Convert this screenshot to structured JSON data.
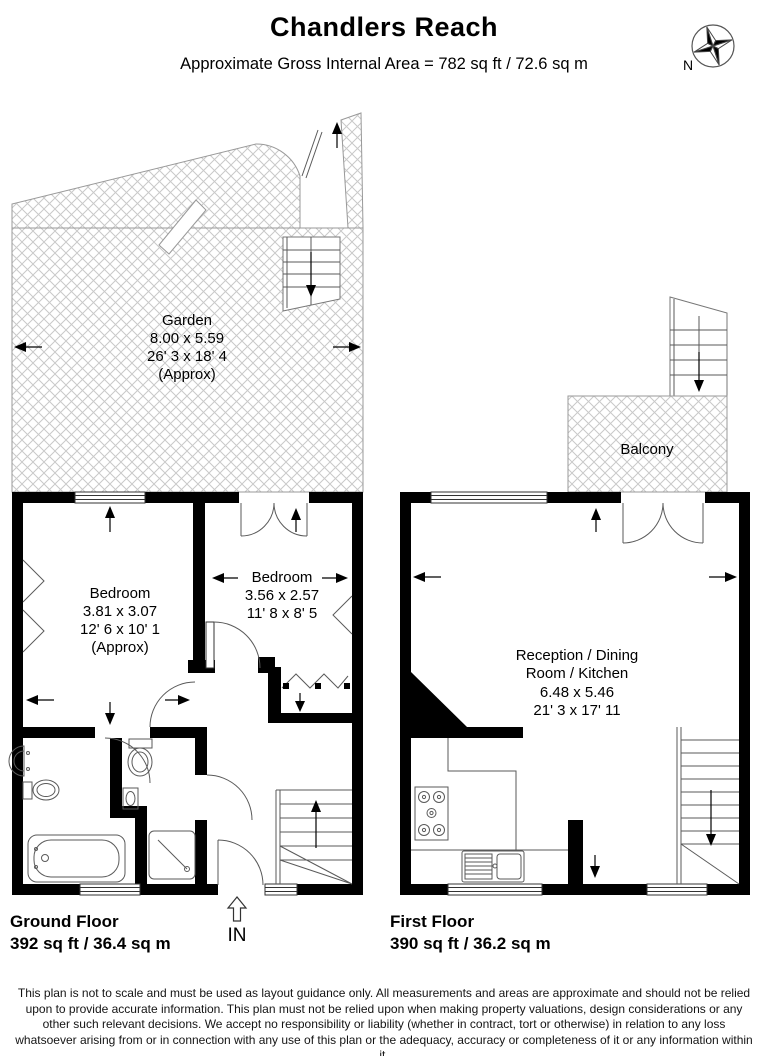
{
  "header": {
    "title": "Chandlers Reach",
    "subtitle": "Approximate Gross Internal Area = 782 sq ft / 72.6 sq m",
    "compass_label": "N"
  },
  "ground_floor": {
    "label": "Ground Floor",
    "area": "392 sq ft / 36.4 sq m",
    "entrance_label": "IN",
    "garden": {
      "name": "Garden",
      "metric": "8.00 x 5.59",
      "imperial": "26' 3 x 18' 4",
      "approx": "(Approx)"
    },
    "bedroom1": {
      "name": "Bedroom",
      "metric": "3.81 x 3.07",
      "imperial": "12' 6 x 10' 1",
      "approx": "(Approx)"
    },
    "bedroom2": {
      "name": "Bedroom",
      "metric": "3.56 x 2.57",
      "imperial": "11' 8 x 8' 5"
    }
  },
  "first_floor": {
    "label": "First Floor",
    "area": "390 sq ft / 36.2 sq m",
    "balcony": {
      "name": "Balcony"
    },
    "reception": {
      "name_line1": "Reception / Dining",
      "name_line2": "Room / Kitchen",
      "metric": "6.48 x 5.46",
      "imperial": "21' 3 x 17' 11"
    }
  },
  "disclaimer": "This plan is not to scale and must be used as layout guidance only. All measurements and areas are approximate and should not be relied upon to provide accurate information. This plan must not be relied upon when making property valuations, design considerations or any other such relevant decisions. We accept no responsibility or liability (whether in contract, tort or otherwise) in relation to any loss whatsoever arising from or in connection with any use of this plan or the adequacy, accuracy or completeness of it or any information within it.",
  "colors": {
    "wall": "#000000",
    "fixture_line": "#5a5a5a",
    "hatch_line": "#c9c9c9",
    "text": "#000000"
  }
}
